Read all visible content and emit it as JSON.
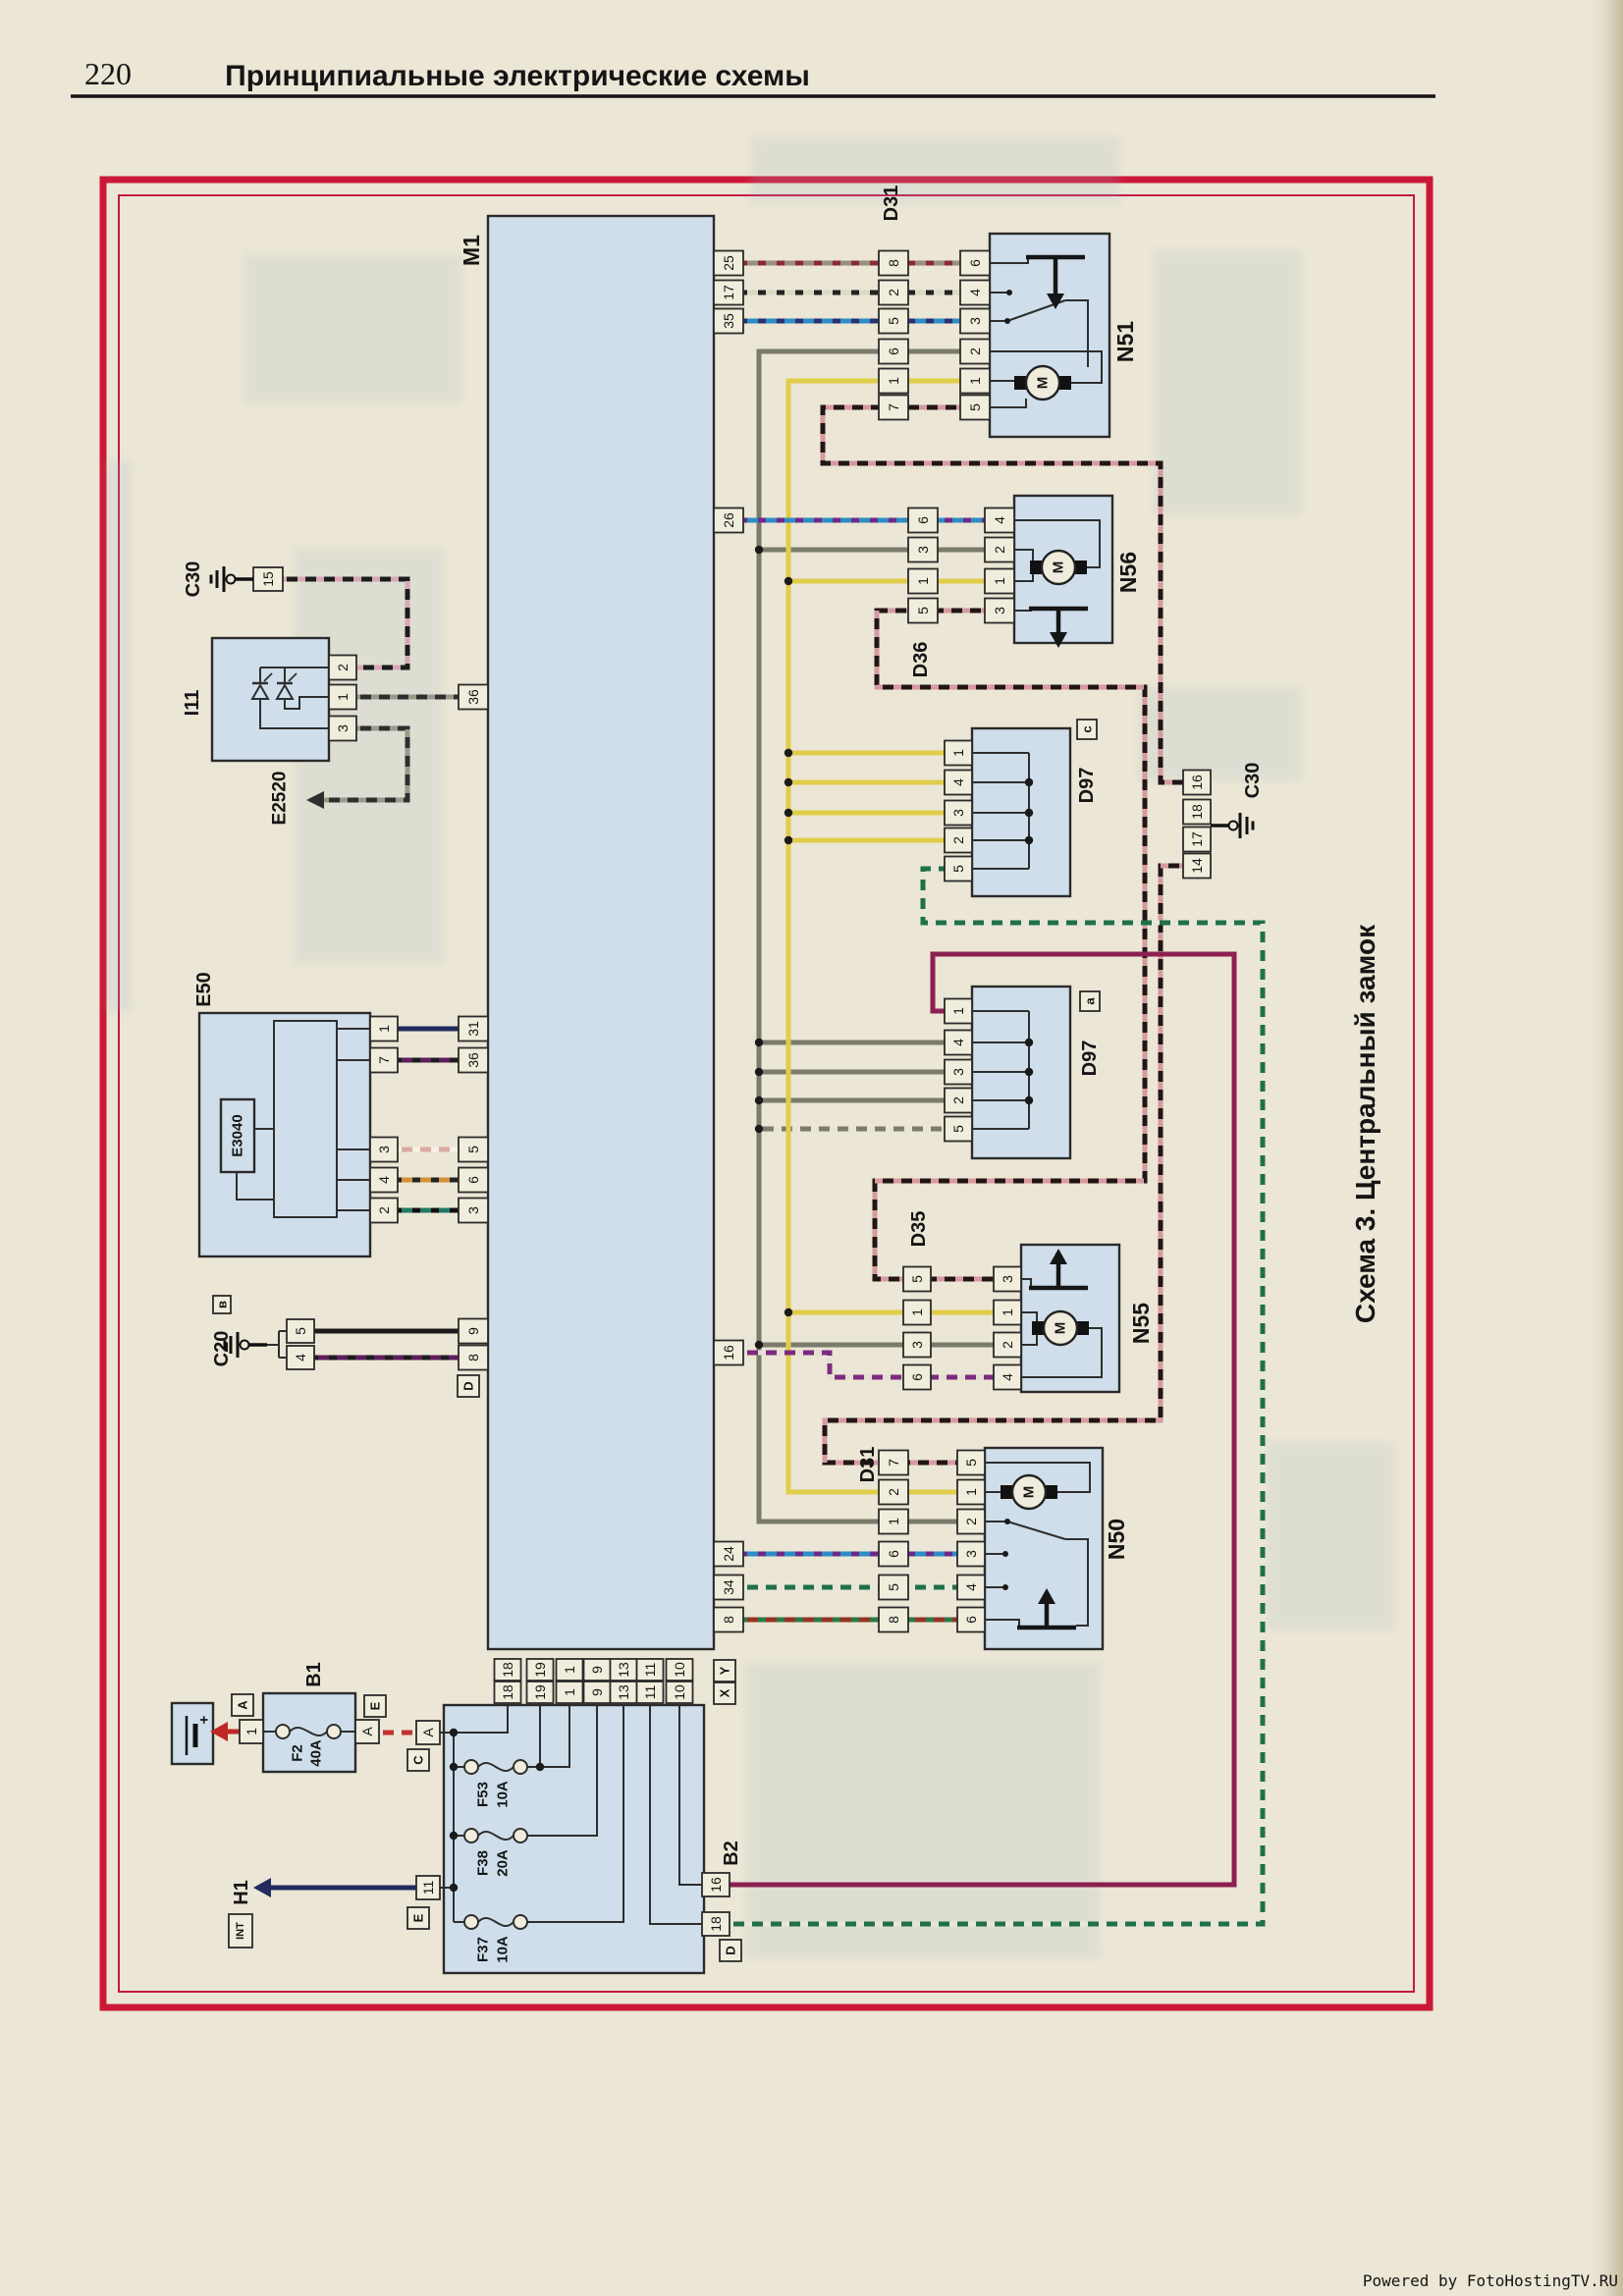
{
  "page": {
    "number": "220",
    "title": "Принципиальные электрические схемы",
    "scheme_title": "Схема 3. Центральный замок",
    "watermark": "Powered by FotoHostingTV.RU"
  },
  "colors": {
    "paper": "#ebe6d5",
    "frame_red": "#cc1838",
    "box_fill": "#cfdeea",
    "ink": "#151515",
    "watermark_red": "#cc2244"
  },
  "components": {
    "m1": "M1",
    "n51": "N51",
    "n56": "N56",
    "n55": "N55",
    "n50": "N50",
    "d31_top": "D31",
    "d31_bottom": "D31",
    "d36": "D36",
    "d35": "D35",
    "d97_c": "D97",
    "d97_c_variant": "c",
    "d97_a": "D97",
    "d97_a_variant": "a",
    "c30_left": "C30",
    "c30_right": "C30",
    "c20": "C20",
    "c20_variant": "в",
    "i11": "I11",
    "e2520": "E2520",
    "e50": "E50",
    "e3040": "E3040",
    "b1": "B1",
    "b2": "B2",
    "h1": "H1",
    "h1_tag": "INT",
    "motor": "M"
  },
  "fuses": {
    "f2": [
      "F2",
      "40A"
    ],
    "f53": [
      "F53",
      "10A"
    ],
    "f38": [
      "F38",
      "20A"
    ],
    "f37": [
      "F37",
      "10A"
    ]
  },
  "connector_letters": {
    "a": "A",
    "e_top": "E",
    "c": "C",
    "e_bottom": "E",
    "d_b2": "D",
    "d_m1": "D",
    "x": "X",
    "y": "Y"
  },
  "pins": {
    "m1_right": [
      "25",
      "17",
      "35",
      "26",
      "16",
      "24",
      "34",
      "8"
    ],
    "m1_left": [
      "36",
      "31",
      "36",
      "5",
      "6",
      "3",
      "9",
      "8"
    ],
    "m1_bottom": [
      "18",
      "19",
      "1",
      "9",
      "13",
      "11",
      "10"
    ],
    "d31_top": [
      "8",
      "2",
      "5",
      "6",
      "1",
      "7"
    ],
    "n51": [
      "6",
      "4",
      "3",
      "2",
      "1",
      "5"
    ],
    "d36": [
      "6",
      "3",
      "1",
      "5"
    ],
    "n56": [
      "4",
      "2",
      "1",
      "3"
    ],
    "d97c": [
      "1",
      "4",
      "3",
      "2",
      "5"
    ],
    "c30_right": [
      "16",
      "18",
      "17",
      "14"
    ],
    "c30_left": [
      "15"
    ],
    "d97a": [
      "1",
      "4",
      "3",
      "2",
      "5"
    ],
    "d35": [
      "5",
      "1",
      "3",
      "6"
    ],
    "n55": [
      "3",
      "1",
      "2",
      "4"
    ],
    "d31_bottom": [
      "7",
      "2",
      "1",
      "6",
      "5",
      "8"
    ],
    "n50": [
      "5",
      "1",
      "2",
      "3",
      "4",
      "6"
    ],
    "i11": [
      "2",
      "1",
      "3"
    ],
    "c20": [
      "5",
      "4"
    ],
    "e50": [
      "1",
      "7",
      "3",
      "4",
      "2"
    ],
    "b1": [
      "1",
      "A"
    ],
    "b2": [
      "A",
      "11",
      "16",
      "18"
    ]
  },
  "wire_colors": {
    "grey": {
      "base": "#7b7b6c"
    },
    "grey_white": {
      "base": "#7b7b6c",
      "stripe": "#e8e4d6"
    },
    "yellow": {
      "base": "#e0cd49"
    },
    "black": {
      "base": "#1c1c1c"
    },
    "navy": {
      "base": "#232a60"
    },
    "maroon": {
      "base": "#8c2050"
    },
    "red": {
      "base": "#bf2727"
    },
    "grey_red": {
      "base": "#96907d",
      "stripe": "#8c2a33"
    },
    "white_black": {
      "base": "#ddd8c5",
      "stripe": "#222222"
    },
    "blue_black": {
      "base": "#2d8cc7",
      "stripe": "#2a3070"
    },
    "blue_purple": {
      "base": "#2d8cc7",
      "stripe": "#6d2a89"
    },
    "black_red": {
      "base": "#231515",
      "stripe": "#d69aa0"
    },
    "purple_white": {
      "base": "#7c2a80",
      "stripe": "#e4e0d3"
    },
    "green_white": {
      "base": "#207049",
      "stripe": "#e8e6d9"
    },
    "red_green": {
      "base": "#953425",
      "stripe": "#2a7a47"
    },
    "purple_black": {
      "base": "#5c1e5e",
      "stripe": "#1c1c1c"
    },
    "pink_white": {
      "base": "#dcaaa1",
      "stripe": "#f6f2e6"
    },
    "orange_black": {
      "base": "#d4913b",
      "stripe": "#222222"
    },
    "teal_black": {
      "base": "#227867",
      "stripe": "#101010"
    },
    "black_grey": {
      "base": "#2e2e2e",
      "stripe": "#9a9a8b"
    },
    "black_pink": {
      "base": "#1c1c1c",
      "stripe": "#d8a8b3"
    },
    "red_white": {
      "base": "#c23030",
      "stripe": "#ece8db"
    }
  }
}
